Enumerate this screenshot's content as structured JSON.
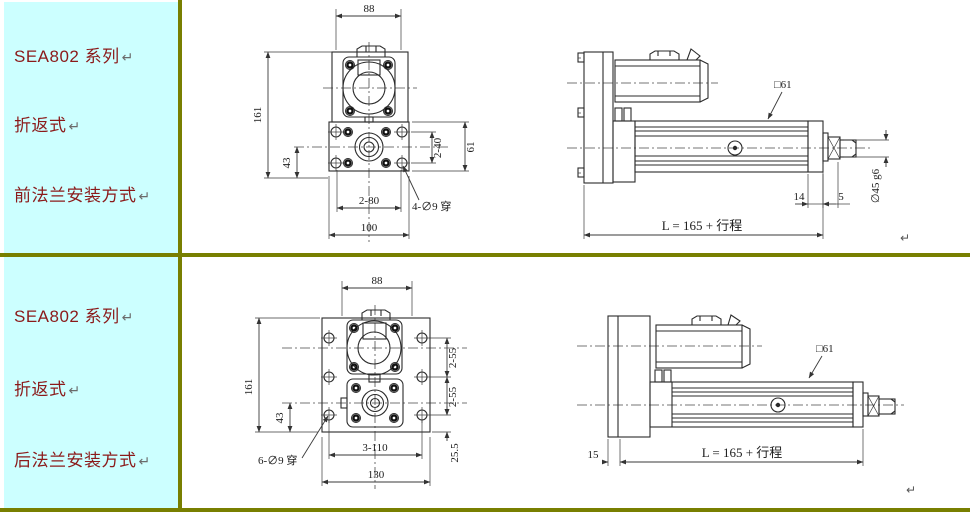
{
  "colors": {
    "table_border": "#787f00",
    "sidebar_background": "#ccffff",
    "sidebar_text": "#8b1a1a",
    "drawing_lines": "#2b2b2b",
    "page_background": "#ffffff"
  },
  "sidebar_rows": [
    {
      "series": "SEA802 系列",
      "type": "折返式",
      "mount": "前法兰安装方式",
      "return_mark": "↵"
    },
    {
      "series": "SEA802 系列",
      "type": "折返式",
      "mount": "后法兰安装方式",
      "return_mark": "↵"
    }
  ],
  "drawings": {
    "front_mount_front_view": {
      "dim_width": "88",
      "dim_height": "161",
      "dim_offset": "43",
      "dim_hole_v": "2-40",
      "dim_flange_h": "61",
      "dim_hole_h": "2-80",
      "dim_flange_w": "100",
      "label_holes": "4-∅9 穿"
    },
    "front_mount_side_view": {
      "label_square": "□61",
      "dim_end": "14",
      "dim_gap": "5",
      "label_shaft": "∅45 g6",
      "dim_length": "L = 165 + 行程",
      "return_mark": "↵"
    },
    "rear_mount_front_view": {
      "dim_width": "88",
      "dim_height": "161",
      "dim_offset": "43",
      "dim_hole_v_upper": "2-55",
      "dim_hole_v_lower": "2-55",
      "dim_bottom": "25.5",
      "label_holes": "6-∅9 穿",
      "dim_hole_h": "3-110",
      "dim_plate_w": "130"
    },
    "rear_mount_side_view": {
      "label_square": "□61",
      "dim_plate_t": "15",
      "dim_length": "L = 165 + 行程",
      "return_mark": "↵"
    }
  }
}
